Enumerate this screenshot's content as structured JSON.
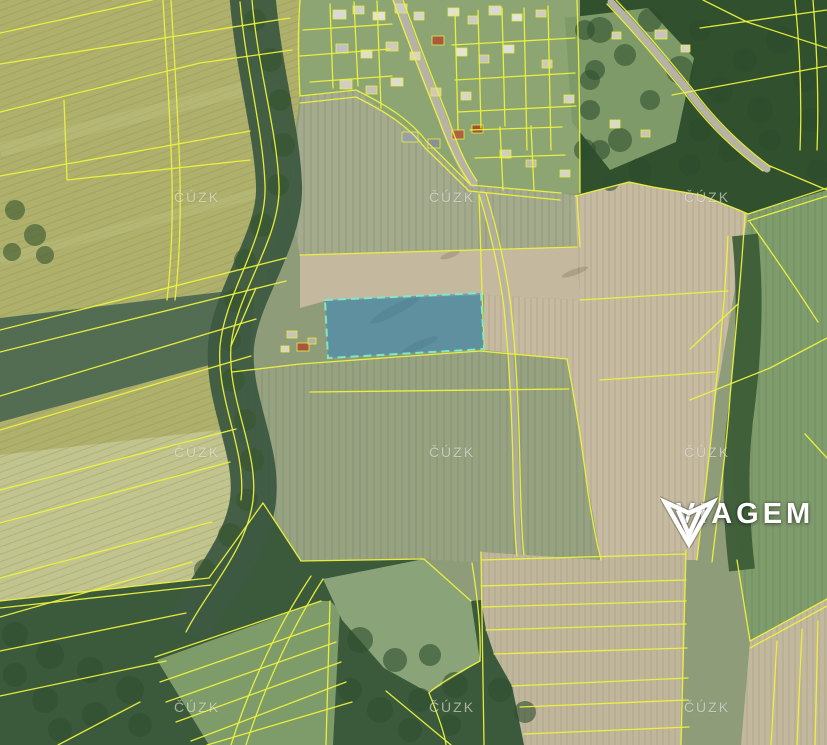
{
  "watermark": {
    "text": "ČÚZK",
    "color": "rgba(255,255,255,0.55)",
    "positions": [
      {
        "x": 197,
        "y": 197
      },
      {
        "x": 452,
        "y": 197
      },
      {
        "x": 707,
        "y": 197
      },
      {
        "x": 197,
        "y": 452
      },
      {
        "x": 452,
        "y": 452
      },
      {
        "x": 707,
        "y": 452
      },
      {
        "x": 197,
        "y": 707
      },
      {
        "x": 452,
        "y": 707
      },
      {
        "x": 707,
        "y": 707
      }
    ]
  },
  "brand": {
    "name": "VIAGEM",
    "logo_icon": "viagem-diamond-v-icon",
    "text_color": "#ffffff"
  },
  "highlight": {
    "points": "325,300 481,293 484,349 328,358",
    "fill": "#3e88b8",
    "fill_opacity": "0.6",
    "stroke": "#7fe9c4"
  },
  "colors": {
    "parcel_line": "#edf23d",
    "field_olive": "#aeb06c",
    "field_beige": "#c6bba0",
    "field_green": "#97a281",
    "forest": "#30502e"
  }
}
